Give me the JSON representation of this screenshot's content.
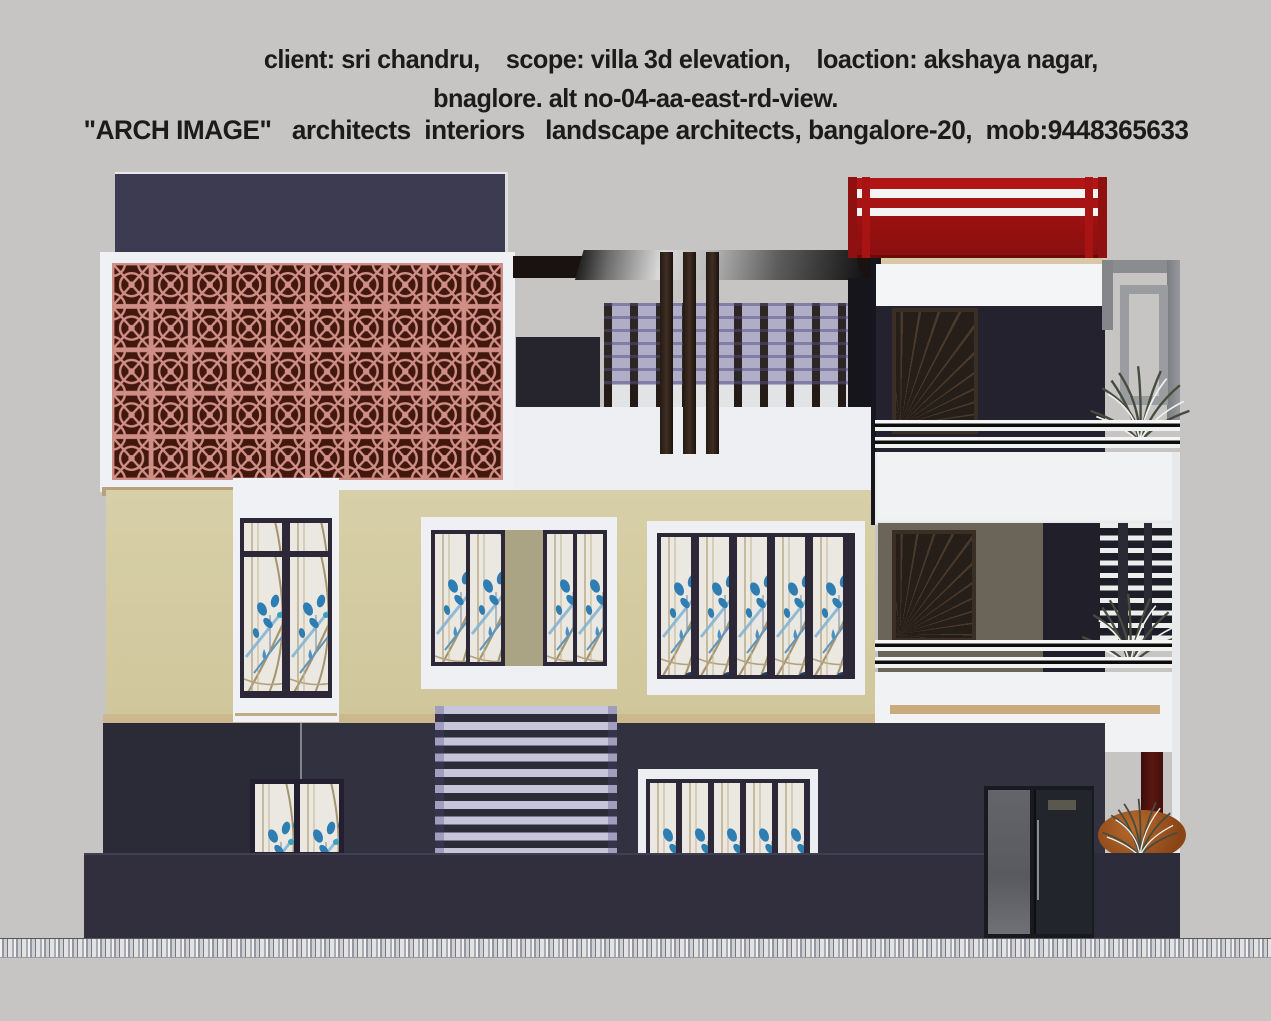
{
  "header": {
    "line1": "client: sri chandru,    scope: villa 3d elevation,    loaction: akshaya nagar,",
    "line2": "bnaglore. alt no-04-aa-east-rd-view.",
    "line3": "\"ARCH IMAGE\"   architects  interiors   landscape architects, bangalore-20,  mob:9448365633"
  },
  "palette": {
    "background": "#c6c5c3",
    "text": "#1b1b1b",
    "navy_wall": "#32313f",
    "dark_navy_wall": "#23222e",
    "beige_wall": "#d4cba2",
    "white_trim": "#f0f1f4",
    "jali_pink": "#cf8e86",
    "jali_dark": "#41170e",
    "red_railing": "#a81414",
    "wood_accent": "#c9ab80",
    "stained_glass_blue": "#2e7eb4",
    "louver_lavender": "#c7c5da",
    "door_brown": "#261e18",
    "taupe_wall": "#6b6458",
    "canopy_gray": "#9b9b9b",
    "plant_green": "#4d5243",
    "shrub_orange": "#a85a24",
    "maroon_pillar": "#511510"
  }
}
